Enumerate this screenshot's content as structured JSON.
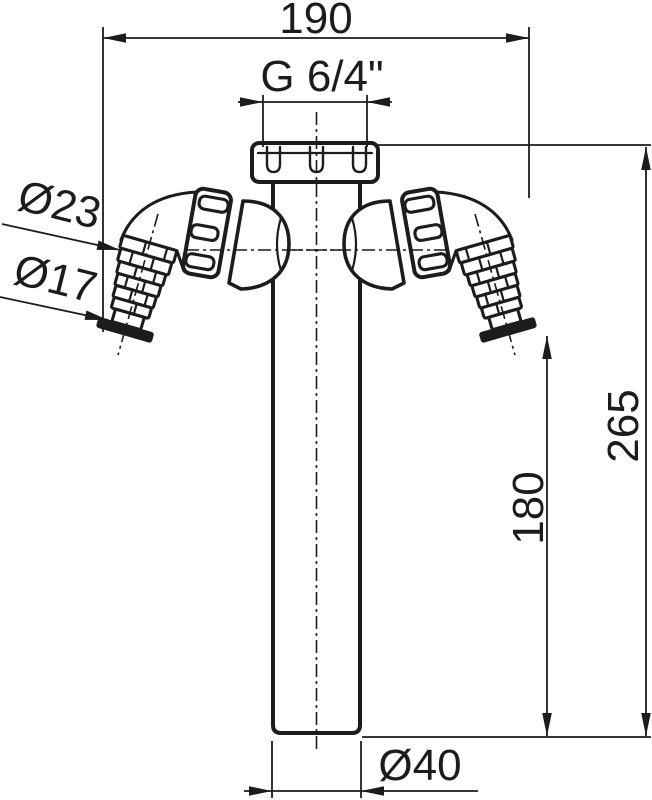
{
  "drawing": {
    "background_color": "#ffffff",
    "line_color": "#1c1c1c",
    "dimensions": {
      "top_width": "190",
      "thread_size": "G 6/4\"",
      "hose_barb_large_dia": "Ø23",
      "hose_barb_small_dia": "Ø17",
      "total_height": "265",
      "hose_tip_to_outlet": "180",
      "outlet_dia": "Ø40"
    }
  }
}
